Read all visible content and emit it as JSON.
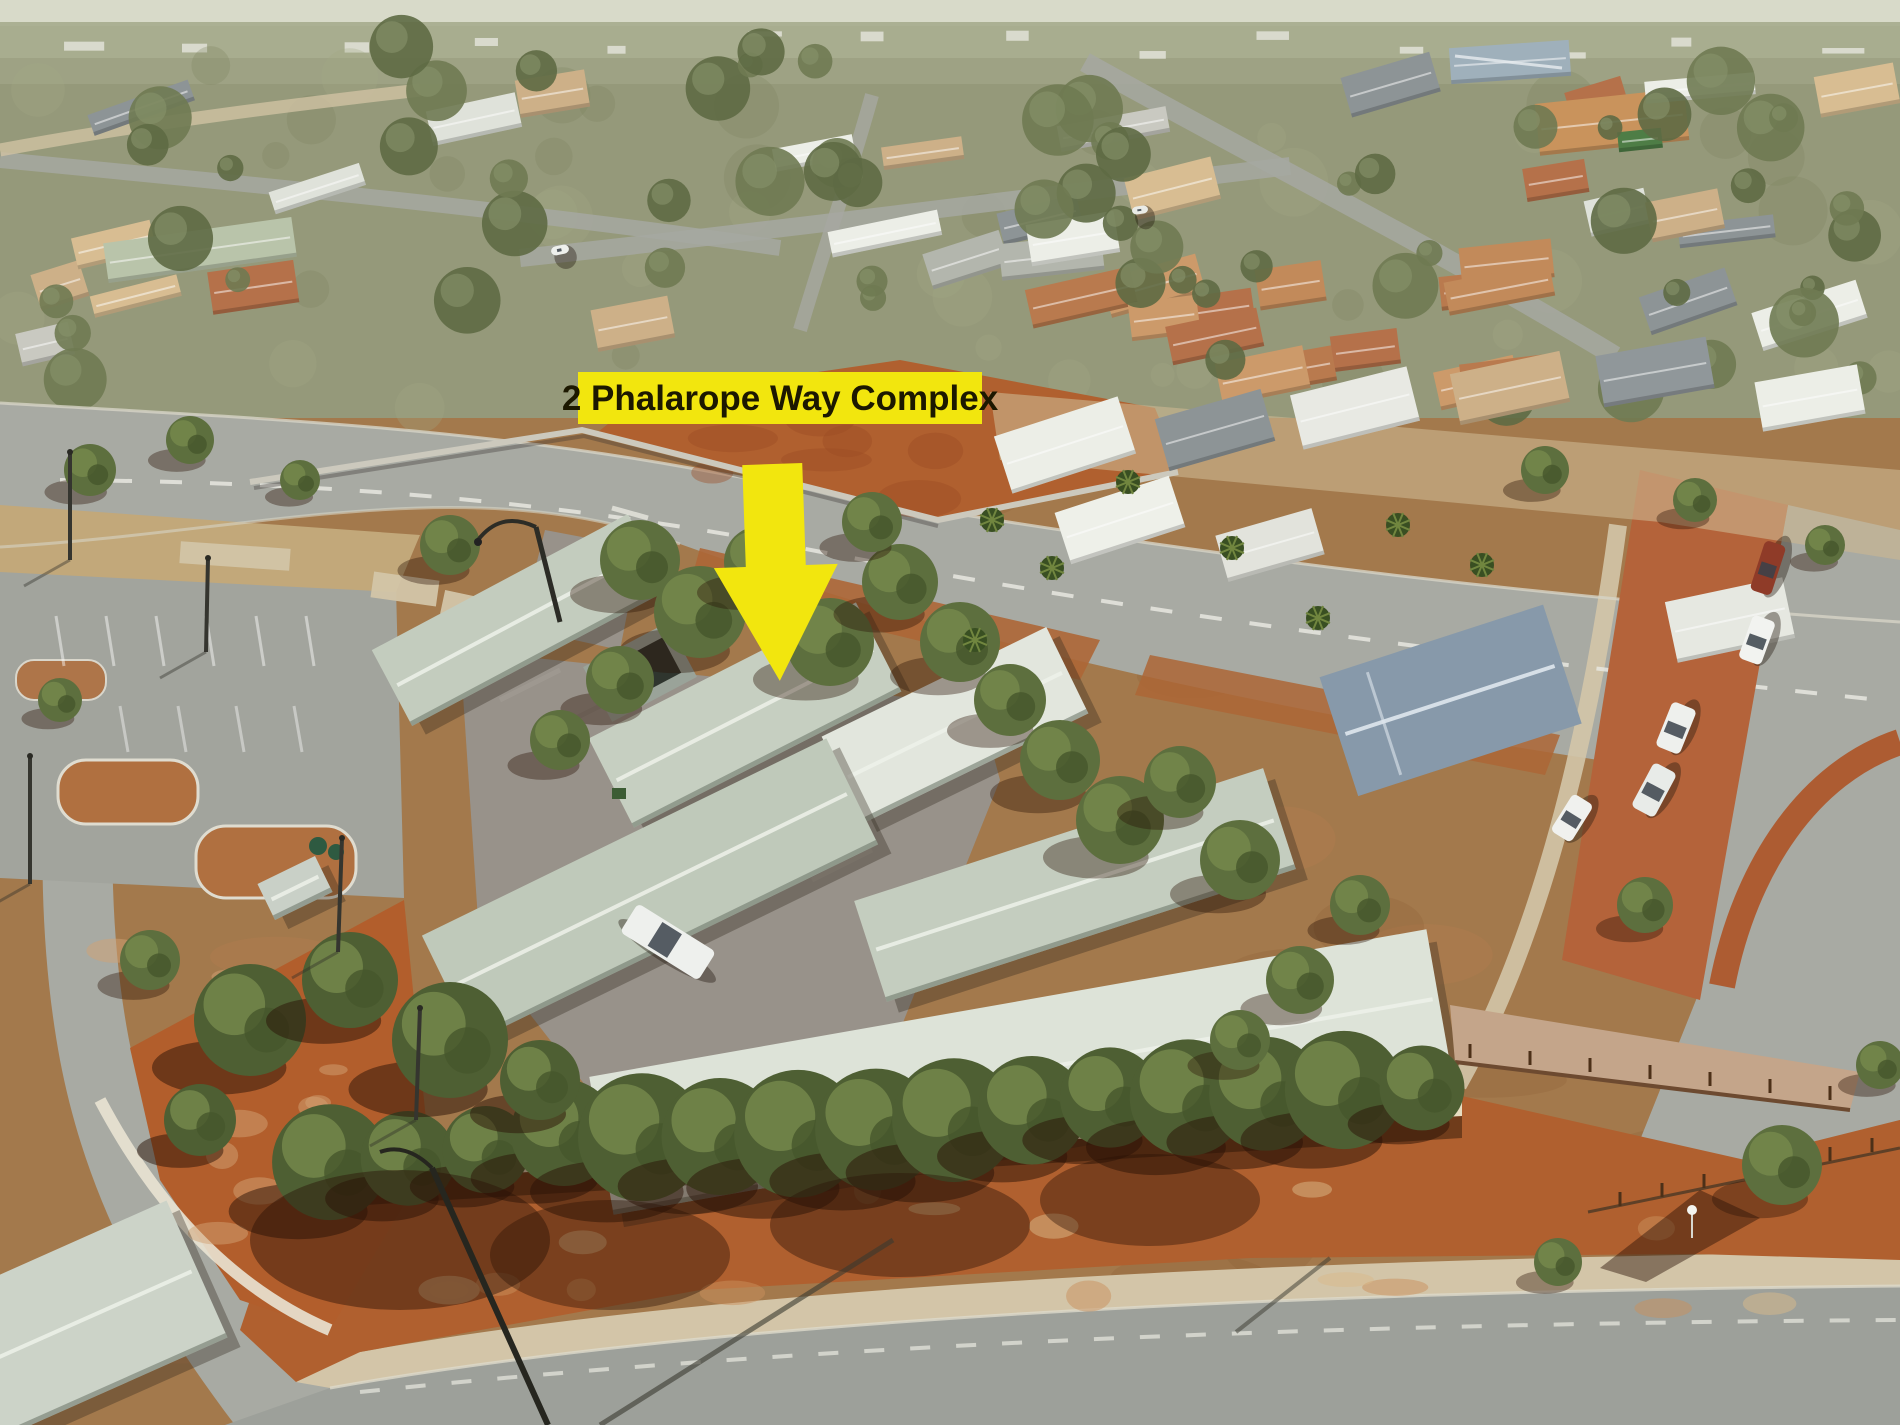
{
  "annotation": {
    "label": "2 Phalarope Way Complex",
    "label_bg": "#f2e60e",
    "label_text_color": "#1c1800",
    "arrow_color": "#f2e60e"
  },
  "signage": {
    "fence_sign_color": "#33549e"
  },
  "palette": {
    "haze": "#d8dac9",
    "scrub": "#a9ae90",
    "suburb_ground": "#95997a",
    "mid_ground": "#a3794c",
    "road": "#a8aaa3",
    "road_light": "#b4b6af",
    "red_dirt": "#b0602f",
    "red_dirt_deep": "#9c4a22",
    "deep_shadow": "#2a1206",
    "complex_roof": "#c3ccbe",
    "complex_roof_light": "#dde3d8",
    "white_roof": "#eceee7",
    "gray_roof": "#8d9496",
    "tan_roof": "#cdb088",
    "terracotta_roof": "#b5714a",
    "blue_roof": "#8799aa",
    "pale_green_roof": "#b9c4aa",
    "courtyard_pavers": "#98928a",
    "footpath": "#d3c5a8",
    "wall_cream": "#e7ddc1",
    "tree_green": "#5d6f3e",
    "tree_green_light": "#77894c",
    "olive_tree": "#6f7a52",
    "car_white": "#eef0ed"
  }
}
